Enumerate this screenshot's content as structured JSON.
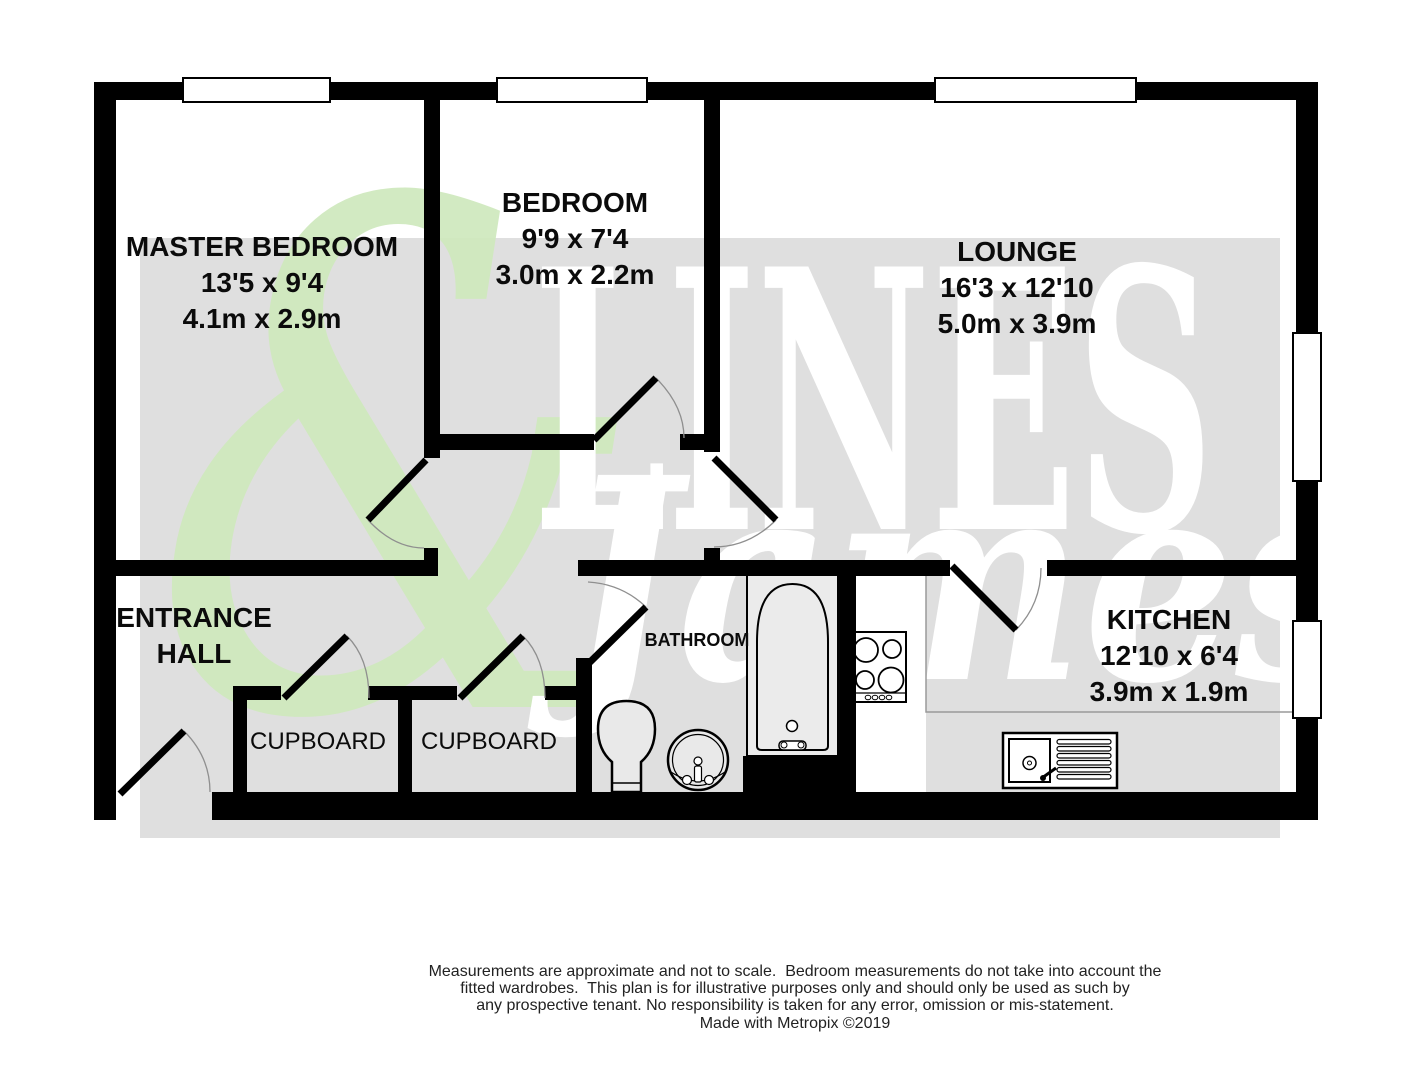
{
  "watermark": {
    "ampersand": "&",
    "brand_top": "LINES",
    "brand_bottom": "James"
  },
  "rooms": {
    "master_bedroom": {
      "name": "MASTER BEDROOM",
      "size_imperial": "13'5 x 9'4",
      "size_metric": "4.1m x 2.9m"
    },
    "bedroom": {
      "name": "BEDROOM",
      "size_imperial": "9'9 x 7'4",
      "size_metric": "3.0m x 2.2m"
    },
    "lounge": {
      "name": "LOUNGE",
      "size_imperial": "16'3 x 12'10",
      "size_metric": "5.0m x 3.9m"
    },
    "kitchen": {
      "name": "KITCHEN",
      "size_imperial": "12'10 x 6'4",
      "size_metric": "3.9m x 1.9m"
    },
    "bathroom": {
      "name": "BATHROOM"
    },
    "entrance_hall": {
      "name_line1": "ENTRANCE",
      "name_line2": "HALL"
    },
    "cupboard_left": {
      "name": "CUPBOARD"
    },
    "cupboard_right": {
      "name": "CUPBOARD"
    }
  },
  "footer": {
    "lines": [
      "Measurements are approximate and not to scale.  Bedroom measurements do not take into account the",
      "fitted wardrobes.  This plan is for illustrative purposes only and should only be used as such by",
      "any prospective tenant. No responsibility is taken for any error, omission or mis-statement.",
      "Made with Metropix ©2019"
    ]
  },
  "colors": {
    "wall": "#000000",
    "watermark_band": "#dfdfdf",
    "watermark_green": "#cfe9bd",
    "watermark_white": "#ffffff"
  }
}
